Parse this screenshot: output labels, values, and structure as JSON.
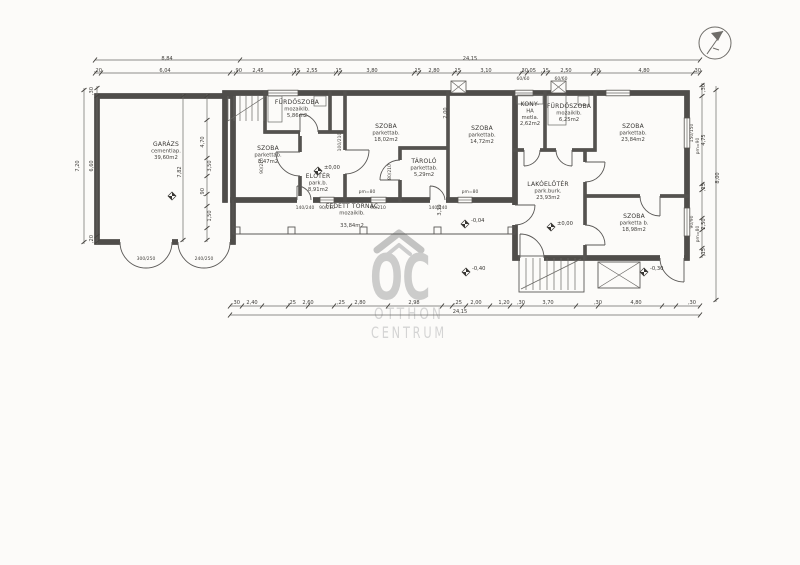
{
  "watermark": {
    "logo": "OC",
    "word1": "OTTHON",
    "word2": "CENTRUM"
  },
  "colors": {
    "ink": "#4f4d4a",
    "paper": "#fcfbf9",
    "watermark": "#c9c9c9"
  },
  "rooms": [
    {
      "id": "garage",
      "x": 166,
      "y": 146,
      "lines": [
        "GARÁZS",
        "cementlap.",
        "39,60m2"
      ]
    },
    {
      "id": "bathroom-1",
      "x": 297,
      "y": 104,
      "lines": [
        "FÜRDŐSZOBA",
        "mozaiklb.",
        "5,86m2"
      ]
    },
    {
      "id": "room-1",
      "x": 268,
      "y": 150,
      "lines": [
        "SZOBA",
        "parkettab.",
        "8,47m2"
      ]
    },
    {
      "id": "foyer",
      "x": 318,
      "y": 178,
      "lines": [
        "ELŐTÉR",
        "park.b.",
        "8,91m2"
      ]
    },
    {
      "id": "room-2",
      "x": 386,
      "y": 128,
      "lines": [
        "SZOBA",
        "parkettab.",
        "18,02m2"
      ]
    },
    {
      "id": "storage",
      "x": 424,
      "y": 163,
      "lines": [
        "TÁROLÓ",
        "parkettab.",
        "5,29m2"
      ]
    },
    {
      "id": "room-3",
      "x": 482,
      "y": 130,
      "lines": [
        "SZOBA",
        "parkettab.",
        "14,72m2"
      ]
    },
    {
      "id": "kitchen",
      "x": 530,
      "y": 106,
      "lines": [
        "KONY-",
        "HA",
        "metla.",
        "2,62m2"
      ]
    },
    {
      "id": "bathroom-2",
      "x": 569,
      "y": 108,
      "lines": [
        "FÜRDŐSZOBA",
        "mozaiklb.",
        "6,25m2"
      ]
    },
    {
      "id": "room-4",
      "x": 633,
      "y": 128,
      "lines": [
        "SZOBA",
        "parkettab.",
        "23,84m2"
      ]
    },
    {
      "id": "entry-hall",
      "x": 548,
      "y": 186,
      "lines": [
        "LAKÓELŐTÉR",
        "park.burk.",
        "23,93m2"
      ]
    },
    {
      "id": "room-5",
      "x": 634,
      "y": 218,
      "lines": [
        "SZOBA",
        "parketta b.",
        "18,98m2"
      ]
    },
    {
      "id": "porch",
      "x": 352,
      "y": 208,
      "lines": [
        "FEDETT TORNÁC",
        "mozaiklb.",
        "",
        "33,84m2"
      ]
    }
  ],
  "levels": [
    {
      "x": 318,
      "y": 171,
      "label": "±0,00"
    },
    {
      "x": 551,
      "y": 227,
      "label": "±0,00"
    },
    {
      "x": 465,
      "y": 224,
      "label": "-0,04"
    },
    {
      "x": 466,
      "y": 272,
      "label": "-0,40"
    },
    {
      "x": 644,
      "y": 272,
      "label": "-0,30"
    },
    {
      "x": 172,
      "y": 196,
      "label": ""
    }
  ],
  "dim_rows": [
    {
      "y": 60,
      "labels": [
        {
          "x": 167,
          "t": "8,84"
        },
        {
          "x": 470,
          "t": "24,15"
        }
      ]
    },
    {
      "y": 72,
      "labels": [
        {
          "x": 98,
          "t": ",20"
        },
        {
          "x": 165,
          "t": "6,04"
        },
        {
          "x": 238,
          "t": ",90"
        },
        {
          "x": 258,
          "t": "2,45"
        },
        {
          "x": 296,
          "t": ",15"
        },
        {
          "x": 312,
          "t": "2,55"
        },
        {
          "x": 338,
          "t": ",15"
        },
        {
          "x": 372,
          "t": "3,80"
        },
        {
          "x": 417,
          "t": ",15"
        },
        {
          "x": 434,
          "t": "2,80"
        },
        {
          "x": 457,
          "t": ",15"
        },
        {
          "x": 486,
          "t": "3,10"
        },
        {
          "x": 524,
          "t": ",30"
        },
        {
          "x": 532,
          "t": ",05"
        },
        {
          "x": 545,
          "t": ",15"
        },
        {
          "x": 566,
          "t": "2,50"
        },
        {
          "x": 596,
          "t": ",30"
        },
        {
          "x": 644,
          "t": "4,80"
        },
        {
          "x": 697,
          "t": ",30"
        }
      ]
    },
    {
      "y": 304,
      "labels": [
        {
          "x": 236,
          "t": ",30"
        },
        {
          "x": 252,
          "t": "2,40"
        },
        {
          "x": 292,
          "t": ",25"
        },
        {
          "x": 308,
          "t": "2,60"
        },
        {
          "x": 341,
          "t": ",25"
        },
        {
          "x": 360,
          "t": "2,80"
        },
        {
          "x": 414,
          "t": "2,98"
        },
        {
          "x": 458,
          "t": ",25"
        },
        {
          "x": 476,
          "t": "2,00"
        },
        {
          "x": 504,
          "t": "1,20"
        },
        {
          "x": 521,
          "t": ",30"
        },
        {
          "x": 548,
          "t": "3,70"
        },
        {
          "x": 598,
          "t": ",30"
        },
        {
          "x": 636,
          "t": "4,80"
        },
        {
          "x": 692,
          "t": ",30"
        }
      ]
    },
    {
      "y": 313,
      "labels": [
        {
          "x": 460,
          "t": "24,15"
        }
      ]
    }
  ],
  "vdim_labels": [
    {
      "x": 79,
      "y": 166,
      "t": "7,20"
    },
    {
      "x": 93,
      "y": 91,
      "t": ",30"
    },
    {
      "x": 93,
      "y": 166,
      "t": "6,60"
    },
    {
      "x": 93,
      "y": 239,
      "t": ",20"
    },
    {
      "x": 719,
      "y": 178,
      "t": "8,00"
    },
    {
      "x": 705,
      "y": 88,
      "t": ",30"
    },
    {
      "x": 705,
      "y": 140,
      "t": "4,75"
    },
    {
      "x": 705,
      "y": 187,
      "t": ",15"
    },
    {
      "x": 705,
      "y": 224,
      "t": "2,50"
    },
    {
      "x": 705,
      "y": 252,
      "t": ",15"
    },
    {
      "x": 181,
      "y": 172,
      "t": "7,82"
    },
    {
      "x": 204,
      "y": 142,
      "t": "4,70"
    },
    {
      "x": 211,
      "y": 166,
      "t": "3,50"
    },
    {
      "x": 204,
      "y": 192,
      "t": ",90"
    },
    {
      "x": 211,
      "y": 216,
      "t": "1,50"
    },
    {
      "x": 447,
      "y": 113,
      "t": "2,00"
    },
    {
      "x": 441,
      "y": 210,
      "t": "3,30"
    }
  ],
  "opening_labels": [
    {
      "x": 146,
      "y": 260,
      "t": "300/250",
      "rot": false
    },
    {
      "x": 204,
      "y": 260,
      "t": "240/250",
      "rot": false
    },
    {
      "x": 305,
      "y": 209,
      "t": "140/240",
      "rot": false
    },
    {
      "x": 327,
      "y": 209,
      "t": "90/210",
      "rot": false
    },
    {
      "x": 378,
      "y": 209,
      "t": "90/210",
      "rot": false
    },
    {
      "x": 438,
      "y": 209,
      "t": "140/240",
      "rot": false
    },
    {
      "x": 263,
      "y": 166,
      "t": "90/210",
      "rot": true
    },
    {
      "x": 341,
      "y": 142,
      "t": "100/210",
      "rot": true
    },
    {
      "x": 391,
      "y": 172,
      "t": "80/210",
      "rot": true
    },
    {
      "x": 523,
      "y": 80,
      "t": "60/60",
      "rot": false
    },
    {
      "x": 561,
      "y": 80,
      "t": "60/60",
      "rot": false
    },
    {
      "x": 693,
      "y": 133,
      "t": "150/150",
      "rot": true
    },
    {
      "x": 699,
      "y": 146,
      "t": "pm=90",
      "rot": true
    },
    {
      "x": 693,
      "y": 222,
      "t": "90/90",
      "rot": true
    },
    {
      "x": 699,
      "y": 234,
      "t": "pm=80",
      "rot": true
    },
    {
      "x": 367,
      "y": 193,
      "t": "pm=80",
      "rot": false
    },
    {
      "x": 470,
      "y": 193,
      "t": "pm=80",
      "rot": false
    }
  ]
}
